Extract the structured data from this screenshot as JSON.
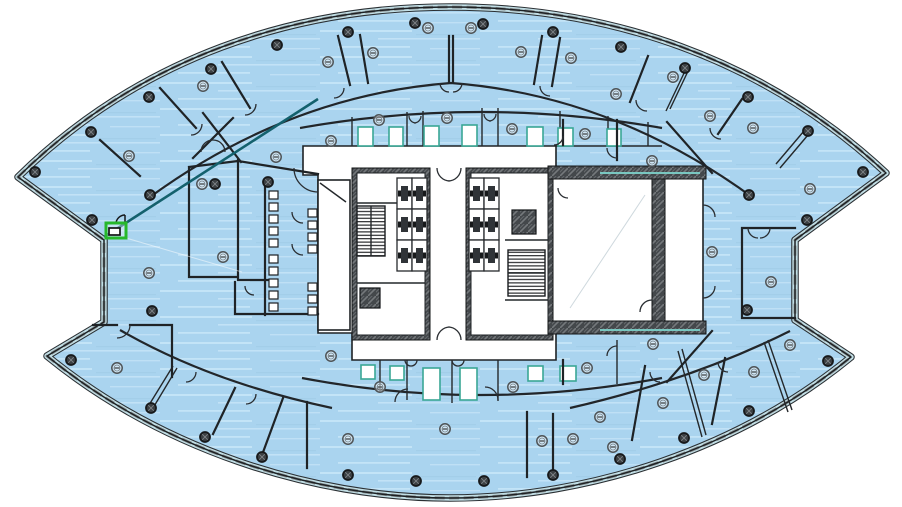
{
  "scene": {
    "kind": "architectural floor plan",
    "background": "#ffffff"
  },
  "palette": {
    "floor_fill": "#aad4ef",
    "floor_streak": "#c8e6f8",
    "floor_streak_dark": "#9fc9e4",
    "outline_dark": "#2a2f33",
    "glass_teal": "#c2dfe6",
    "mullion_gray": "#8d9496",
    "wall_black": "#1f2326",
    "core_hatch": "#44484b",
    "accent_teal": "#14616d",
    "highlight_green": "#27b82b",
    "column_dark": "#3b3f42",
    "device_gray": "#4f5457",
    "shaft_teal": "#3aa795"
  },
  "markers": {
    "columns": [
      [
        35,
        172
      ],
      [
        91,
        132
      ],
      [
        149,
        97
      ],
      [
        211,
        69
      ],
      [
        277,
        45
      ],
      [
        348,
        32
      ],
      [
        415,
        23
      ],
      [
        483,
        24
      ],
      [
        553,
        32
      ],
      [
        621,
        47
      ],
      [
        685,
        68
      ],
      [
        748,
        97
      ],
      [
        808,
        131
      ],
      [
        863,
        172
      ],
      [
        92,
        220
      ],
      [
        150,
        195
      ],
      [
        215,
        184
      ],
      [
        268,
        182
      ],
      [
        749,
        195
      ],
      [
        807,
        220
      ],
      [
        747,
        310
      ],
      [
        152,
        311
      ],
      [
        71,
        360
      ],
      [
        151,
        408
      ],
      [
        205,
        437
      ],
      [
        262,
        457
      ],
      [
        348,
        475
      ],
      [
        416,
        481
      ],
      [
        484,
        481
      ],
      [
        553,
        475
      ],
      [
        620,
        459
      ],
      [
        684,
        438
      ],
      [
        749,
        411
      ],
      [
        828,
        361
      ]
    ],
    "devices": [
      [
        203,
        86
      ],
      [
        276,
        157
      ],
      [
        202,
        184
      ],
      [
        129,
        156
      ],
      [
        149,
        273
      ],
      [
        223,
        257
      ],
      [
        117,
        368
      ],
      [
        331,
        141
      ],
      [
        379,
        120
      ],
      [
        447,
        118
      ],
      [
        512,
        129
      ],
      [
        585,
        134
      ],
      [
        328,
        62
      ],
      [
        373,
        53
      ],
      [
        428,
        28
      ],
      [
        471,
        28
      ],
      [
        521,
        52
      ],
      [
        571,
        58
      ],
      [
        616,
        94
      ],
      [
        673,
        77
      ],
      [
        710,
        116
      ],
      [
        753,
        128
      ],
      [
        652,
        161
      ],
      [
        810,
        189
      ],
      [
        712,
        252
      ],
      [
        771,
        282
      ],
      [
        790,
        345
      ],
      [
        653,
        344
      ],
      [
        663,
        403
      ],
      [
        704,
        375
      ],
      [
        754,
        372
      ],
      [
        613,
        447
      ],
      [
        600,
        417
      ],
      [
        445,
        429
      ],
      [
        348,
        439
      ],
      [
        380,
        387
      ],
      [
        513,
        387
      ],
      [
        331,
        356
      ],
      [
        542,
        441
      ],
      [
        573,
        439
      ],
      [
        587,
        368
      ]
    ]
  },
  "fixtures": {
    "stalls": [
      [
        269,
        191
      ],
      [
        269,
        203
      ],
      [
        269,
        215
      ],
      [
        269,
        227
      ],
      [
        269,
        239
      ],
      [
        269,
        255
      ],
      [
        269,
        267
      ],
      [
        269,
        279
      ],
      [
        269,
        291
      ],
      [
        269,
        303
      ]
    ],
    "urinals": [
      [
        308,
        209
      ],
      [
        308,
        221
      ],
      [
        308,
        233
      ],
      [
        308,
        245
      ],
      [
        308,
        283
      ],
      [
        308,
        295
      ],
      [
        308,
        307
      ]
    ]
  },
  "elevator_banks": [
    {
      "x": 397,
      "y": 178,
      "cols": 2,
      "rows": 3,
      "cell_w": 15,
      "cell_h": 31
    },
    {
      "x": 469,
      "y": 178,
      "cols": 2,
      "rows": 3,
      "cell_w": 15,
      "cell_h": 31
    }
  ],
  "highlight": {
    "x": 106,
    "y": 223,
    "width": 20,
    "height": 15,
    "stroke": "#27b82b",
    "stroke_width": 3
  },
  "accent_wall": {
    "x1": 104,
    "y1": 237,
    "x2": 318,
    "y2": 99,
    "color": "#14616d"
  }
}
